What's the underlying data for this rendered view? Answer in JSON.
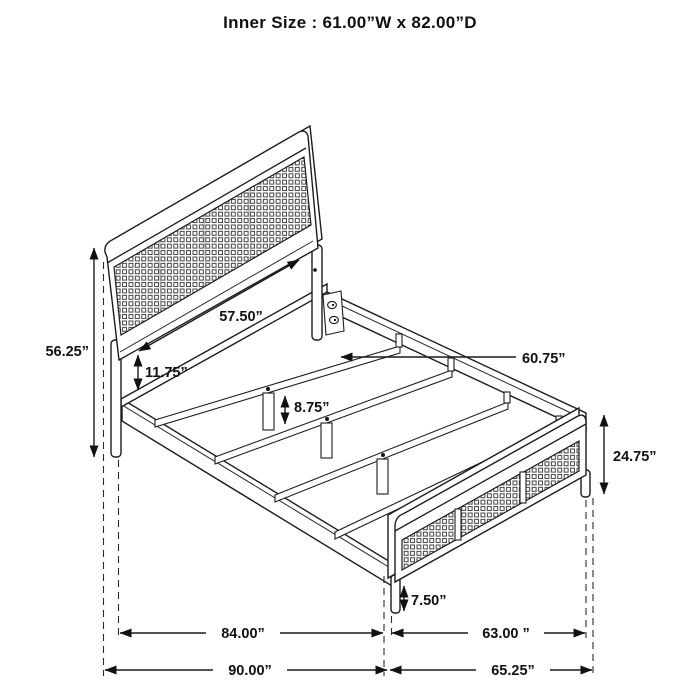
{
  "title": "Inner Size : 61.00”W x 82.00”D",
  "diagram_type": "bed-frame-dimension-drawing",
  "dimensions": {
    "headboard_panel_width": "57.50”",
    "headboard_height": "56.25”",
    "headboard_bottom_to_rail_gap": "11.75”",
    "slat_length": "60.75”",
    "center_support_leg_height": "8.75”",
    "footboard_height": "24.75”",
    "footboard_leg_height": "7.50”",
    "frame_length_inner": "84.00”",
    "footboard_span_inner": "63.00 ”",
    "overall_length": "90.00”",
    "footboard_span_overall": "65.25”"
  }
}
